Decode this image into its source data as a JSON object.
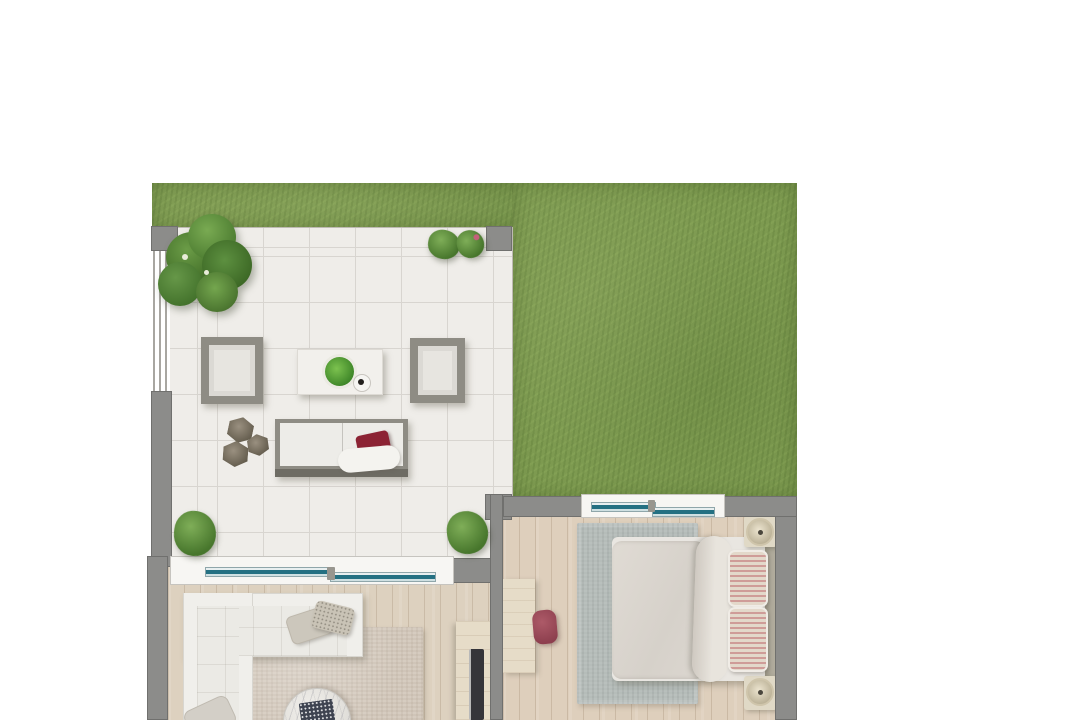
{
  "meta": {
    "type": "architectural-floor-plan",
    "view": "top-down",
    "text_visible": false
  },
  "colors": {
    "grass": "#7d9a50",
    "tile": "#efede9",
    "tile_line": "#d8d5d0",
    "wall": "#8c8c8a",
    "sill": "#f7f6f3",
    "glass": "#247082",
    "wood_living": "#ddd1bf",
    "wood_bedroom": "#decfbc",
    "rug_living": "#d6ccc0",
    "rug_bedroom": "#b5bcb9",
    "sofa_frame": "#8e8c84",
    "cushion": "#e7e5e0",
    "red_pillow": "#8c2334",
    "headboard": "#b2ad9e",
    "desk_wood": "#e6dcc8",
    "tv_dark": "#35353a",
    "chair_maroon": "#9e4b59",
    "foliage_dark": "#3f6b26",
    "foliage_light": "#79aa52"
  },
  "rooms": [
    {
      "id": "garden",
      "label": "garden lawn",
      "surface": "grass"
    },
    {
      "id": "terrace",
      "label": "tiled terrace",
      "surface": "stone tiles",
      "furniture": [
        "outdoor sofa with dark-red pillow and white throw",
        "two framed armchairs",
        "coffee table with potted plant and cup",
        "three hexagonal stone poufs",
        "corner tree",
        "four bushes"
      ]
    },
    {
      "id": "living-room",
      "label": "living room",
      "surface": "wood planks",
      "furniture": [
        "L-shaped white sectional sofa with two pillows",
        "beige area rug",
        "round marble coffee table with book",
        "TV sideboard with television",
        "armchair partially visible at bottom edge"
      ]
    },
    {
      "id": "bedroom",
      "label": "bedroom",
      "surface": "wood planks",
      "furniture": [
        "double bed with folded duvet and two striped pillows",
        "headboard",
        "two round bedside lamps on stands",
        "gray-blue area rug",
        "desk against wall",
        "maroon stool"
      ]
    }
  ],
  "openings": [
    {
      "id": "lr-sliding-door",
      "label": "sliding glass door between terrace and living room"
    },
    {
      "id": "br-window",
      "label": "window between garden and bedroom"
    }
  ],
  "structure": [
    {
      "id": "pillars",
      "label": "three gray corner pillars on terrace"
    },
    {
      "id": "railing",
      "label": "railing on west edge of terrace"
    },
    {
      "id": "walls",
      "label": "gray walls around living room and bedroom"
    }
  ]
}
